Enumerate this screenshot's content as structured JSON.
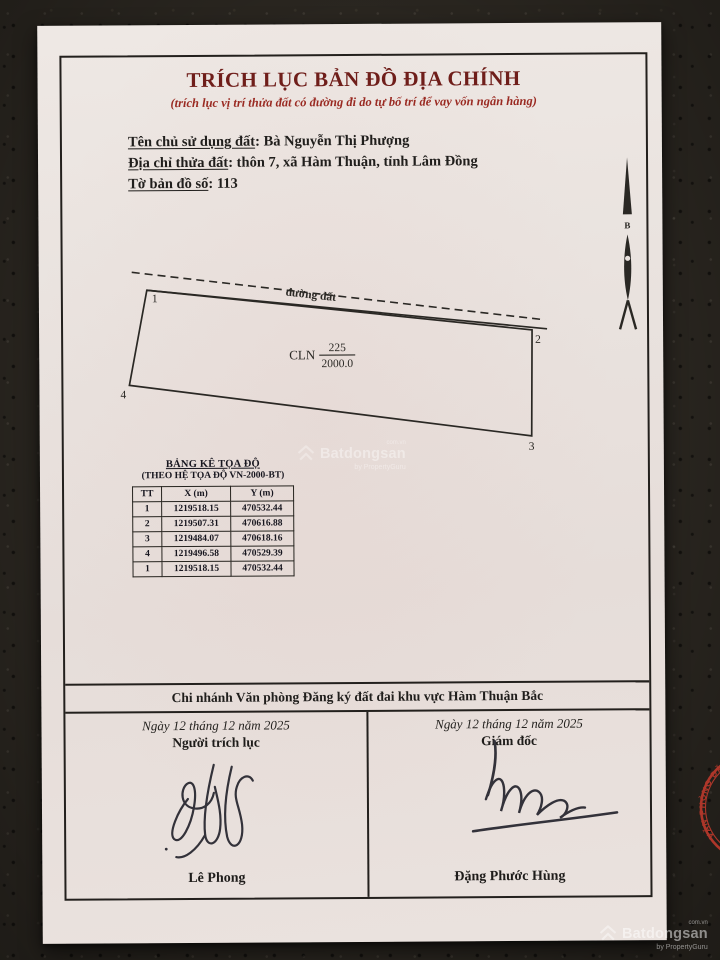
{
  "document": {
    "title": "TRÍCH LỤC BẢN ĐỒ ĐỊA CHÍNH",
    "subtitle": "(trích lục vị trí thửa đất có đường đi do tự bố trí để vay vốn ngân hàng)",
    "separator": ":",
    "info_lines": [
      {
        "label": "Tên chủ sử dụng đất",
        "value": "Bà Nguyễn Thị Phượng"
      },
      {
        "label": "Địa chỉ thửa đất",
        "value": "thôn 7, xã Hàm Thuận, tỉnh Lâm Đồng"
      },
      {
        "label": "Tờ bản đồ số",
        "value": "113"
      }
    ]
  },
  "map": {
    "north_label": "B",
    "road_label": "đường đất",
    "parcel": {
      "land_use_code": "CLN",
      "parcel_number": "225",
      "area": "2000.0",
      "vertices": [
        "1",
        "2",
        "3",
        "4"
      ]
    }
  },
  "coordinate_table": {
    "title": "BẢNG KÊ TỌA ĐỘ",
    "subtitle": "(THEO HỆ TỌA ĐỘ VN-2000-BT)",
    "headers": [
      "TT",
      "X (m)",
      "Y (m)"
    ],
    "rows": [
      [
        "1",
        "1219518.15",
        "470532.44"
      ],
      [
        "2",
        "1219507.31",
        "470616.88"
      ],
      [
        "3",
        "1219484.07",
        "470618.16"
      ],
      [
        "4",
        "1219496.58",
        "470529.39"
      ],
      [
        "1",
        "1219518.15",
        "470532.44"
      ]
    ]
  },
  "footer": {
    "office_title": "Chi nhánh Văn phòng Đăng ký đất đai khu vực Hàm Thuận Bắc",
    "left": {
      "date": "Ngày 12 tháng 12 năm 2025",
      "role": "Người trích lục",
      "name": "Lê Phong"
    },
    "right": {
      "date": "Ngày 12 tháng 12 năm 2025",
      "role": "Giám đốc",
      "name": "Đặng Phước Hùng"
    }
  },
  "stamp": {
    "ring_text": "VĂN PHÒNG ĐĂNG KÝ ĐẤT ĐAI TỈNH LÂM ĐỒNG",
    "star": "★",
    "center_lines": [
      "CHI NHÁNH",
      "VĂN PHÒNG",
      "ĐĂNG KÝ ĐẤT ĐAI",
      "KHU VỰC",
      "HÀM THUẬN BẮC"
    ]
  },
  "watermark": {
    "brand": "Batdongsan",
    "byline": "by PropertyGuru",
    "domain": "com.vn"
  },
  "colors": {
    "title_red": "#6f1e1a",
    "subtitle_red": "#9a2a22",
    "stamp_red": "#c23a2c",
    "ink": "#201e1c",
    "paper": "#e9e2de"
  }
}
